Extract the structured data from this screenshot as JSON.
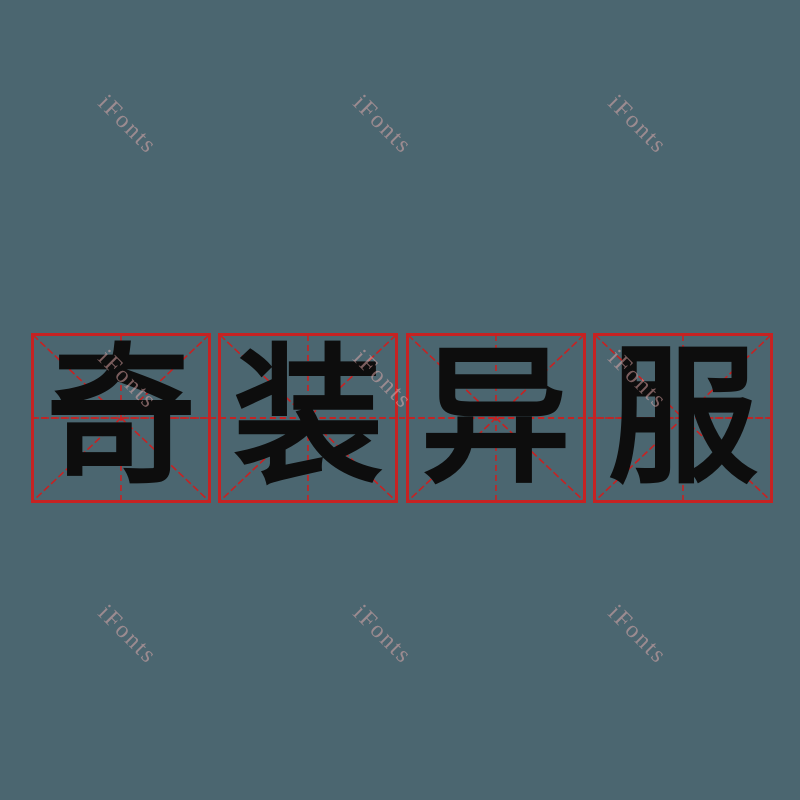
{
  "canvas": {
    "background_color": "#4b6670",
    "width": 800,
    "height": 800
  },
  "watermark": {
    "text": "iFonts",
    "color": "rgba(235,175,175,0.5)",
    "rotation_deg": 45,
    "count": 9,
    "grid": {
      "rows": 3,
      "cols": 3,
      "first_center_x": 127,
      "first_center_y": 125,
      "step_x": 255,
      "step_y": 255
    }
  },
  "phrase": {
    "text": "奇装异服",
    "characters": [
      "奇",
      "装",
      "异",
      "服"
    ],
    "ink_color": "#0d0d0d"
  },
  "grid": {
    "style_name": "mi-zi-ge practice square",
    "line_color": "#c62222",
    "cell_count": 4
  }
}
